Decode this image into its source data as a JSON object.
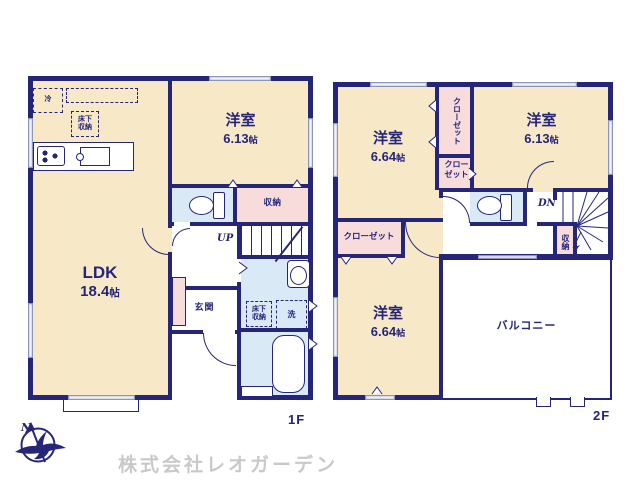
{
  "watermark": "株式会社レオガーデン",
  "compass": {
    "north": "N"
  },
  "floor1": {
    "label": "1F",
    "ldk": {
      "name": "LDK",
      "size": "18.4",
      "unit": "帖"
    },
    "bedroom": {
      "name": "洋室",
      "size": "6.13",
      "unit": "帖"
    },
    "closet": "収納",
    "entrance": "玄関",
    "stairs": "UP",
    "fridge": "冷",
    "underfloor_storage": "床下収納",
    "laundry": "洗"
  },
  "floor2": {
    "label": "2F",
    "bedroom_nw": {
      "name": "洋室",
      "size": "6.64",
      "unit": "帖"
    },
    "bedroom_ne": {
      "name": "洋室",
      "size": "6.13",
      "unit": "帖"
    },
    "bedroom_sw": {
      "name": "洋室",
      "size": "6.64",
      "unit": "帖"
    },
    "closet": "クローゼット",
    "storage": "収納",
    "stairs": "DN",
    "balcony": "バルコニー"
  },
  "colors": {
    "wall": "#262679",
    "cream": "#f7e9c8",
    "pink": "#f8dcdc",
    "blue": "#d9e9f6",
    "watermark": "#c9c9c9"
  }
}
